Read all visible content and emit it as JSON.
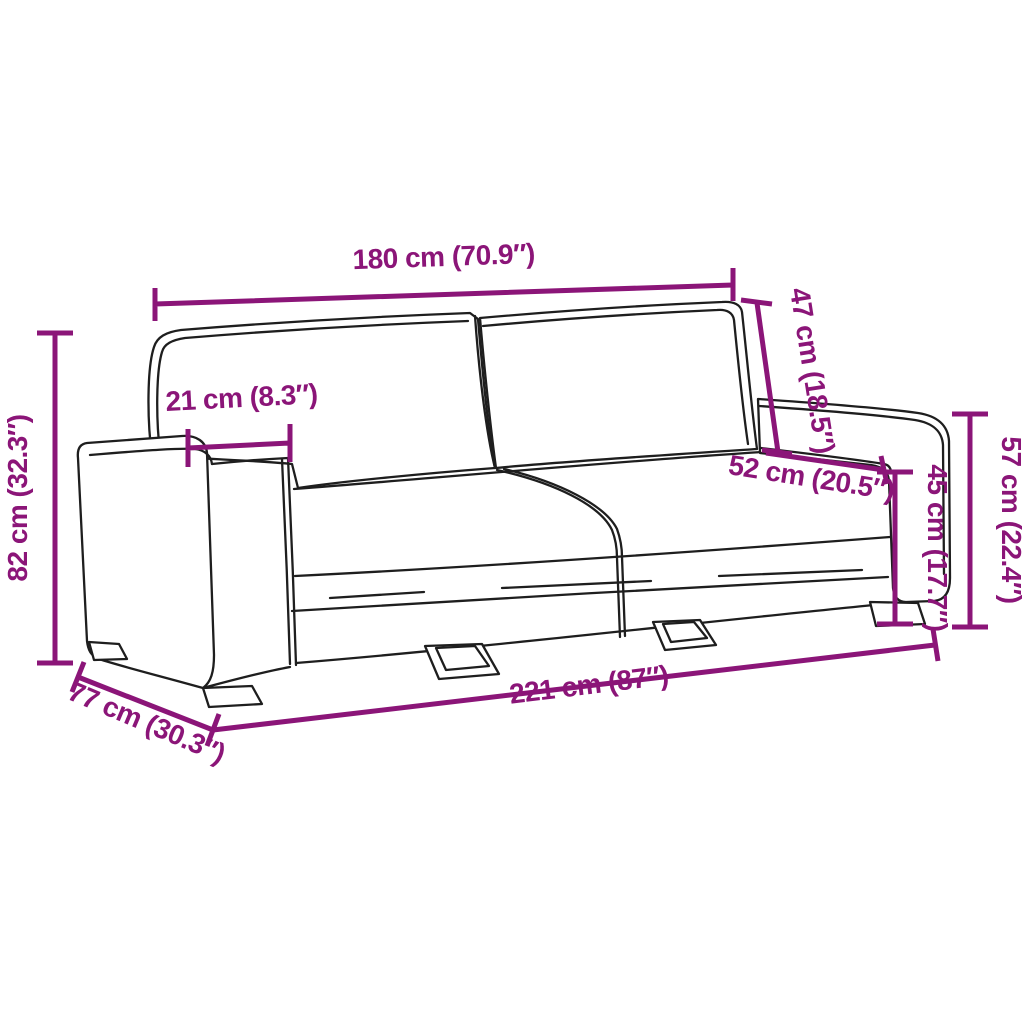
{
  "diagram": {
    "subject": "three-seater sofa line drawing with dimension annotations",
    "background_color": "#ffffff",
    "accent_color": "#8B1578",
    "outline_color": "#1e1e1e",
    "dimensions": {
      "back_width": {
        "label": "180 cm (70.9″)",
        "cm": "180",
        "inches": "70.9",
        "orientation": "horizontal-top"
      },
      "backrest_height": {
        "label": "47 cm (18.5″)",
        "cm": "47",
        "inches": "18.5",
        "orientation": "diagonal-backrest"
      },
      "armrest_width": {
        "label": "21 cm (8.3″)",
        "cm": "21",
        "inches": "8.3",
        "orientation": "horizontal-armrest"
      },
      "seat_depth": {
        "label": "52 cm (20.5″)",
        "cm": "52",
        "inches": "20.5",
        "orientation": "diagonal-seat"
      },
      "seat_height": {
        "label": "45 cm (17.7″)",
        "cm": "45",
        "inches": "17.7",
        "orientation": "vertical-right-inner"
      },
      "armrest_height": {
        "label": "57 cm (22.4″)",
        "cm": "57",
        "inches": "22.4",
        "orientation": "vertical-right-outer"
      },
      "total_height": {
        "label": "82 cm (32.3″)",
        "cm": "82",
        "inches": "32.3",
        "orientation": "vertical-left"
      },
      "depth": {
        "label": "77 cm (30.3″)",
        "cm": "77",
        "inches": "30.3",
        "orientation": "diagonal-bottom-left"
      },
      "total_width": {
        "label": "221 cm (87″)",
        "cm": "221",
        "inches": "87",
        "orientation": "horizontal-bottom"
      }
    }
  }
}
